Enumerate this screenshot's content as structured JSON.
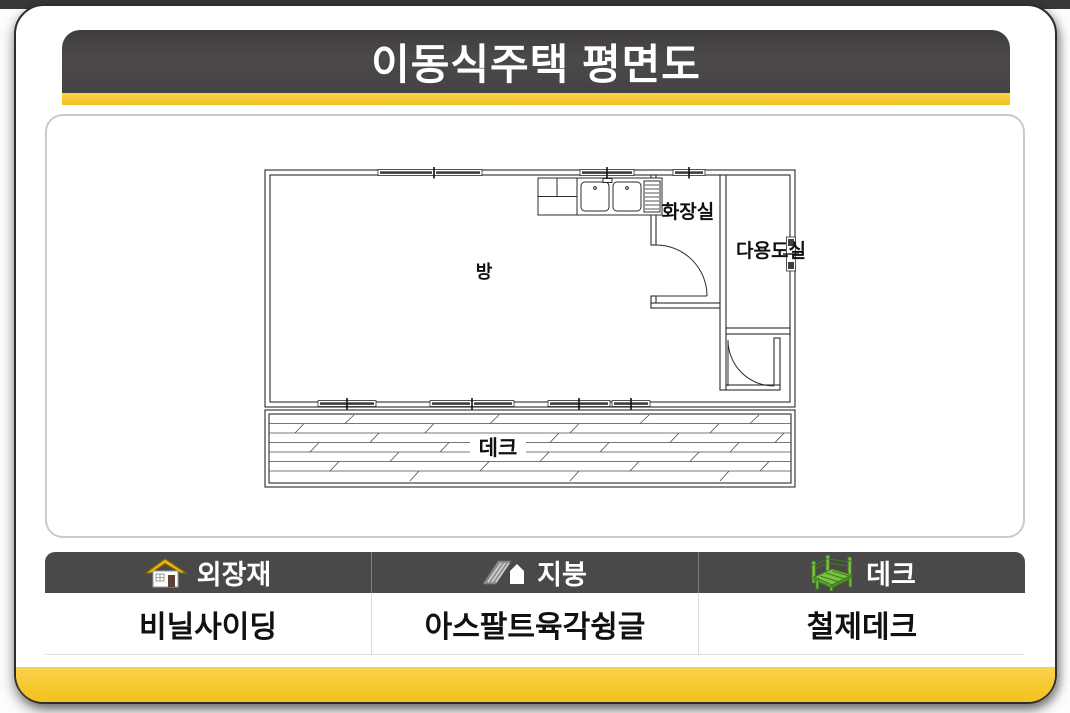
{
  "title_bar": {
    "title": "이동식주택 평면도"
  },
  "floor_plan": {
    "labels": {
      "room": "방",
      "bathroom": "화장실",
      "utility_room": "다용도실",
      "deck": "데크"
    }
  },
  "spec_table": {
    "columns": [
      {
        "icon": "house-icon",
        "header": "외장재",
        "value": "비닐사이딩"
      },
      {
        "icon": "roof-icon",
        "header": "지붕",
        "value": "아스팔트육각슁글"
      },
      {
        "icon": "deck-icon",
        "header": "데크",
        "value": "철제데크"
      }
    ]
  },
  "colors": {
    "accent_yellow": "#F5C62C",
    "header_dark": "#4B4849",
    "plan_line": "#2B2B2B",
    "house_roof_yellow": "#F2B90D",
    "roof_icon_gray": "#8F8F8F",
    "deck_icon_green": "#7CC142"
  }
}
